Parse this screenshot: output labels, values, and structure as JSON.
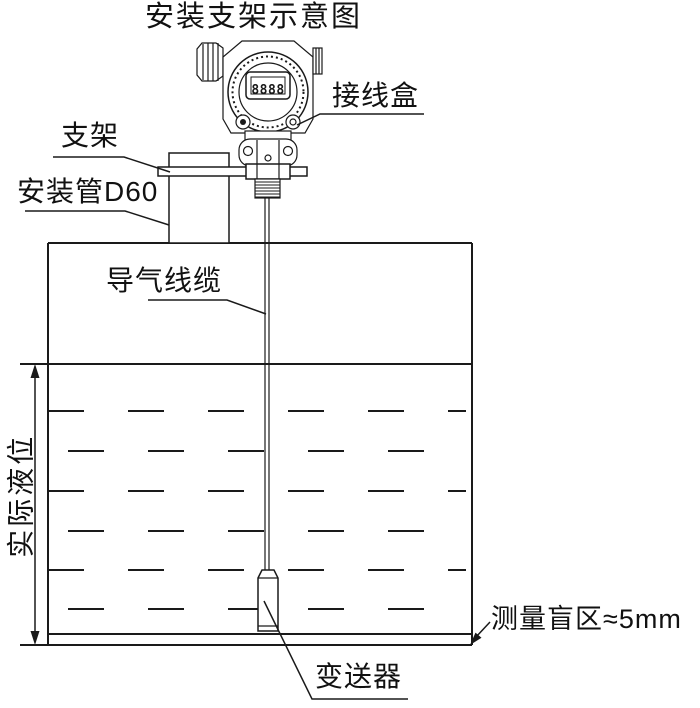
{
  "title": "安装支架示意图",
  "device": {
    "lcd_value": "8888"
  },
  "labels": {
    "junction_box": "接线盒",
    "bracket": "支架",
    "mounting_pipe": "安装管D60",
    "air_cable": "导气线缆",
    "actual_level": "实际液位",
    "transmitter": "变送器",
    "blind_zone": "测量盲区≈5mm"
  },
  "colors": {
    "line": "#1a1a1a",
    "background": "#ffffff"
  }
}
